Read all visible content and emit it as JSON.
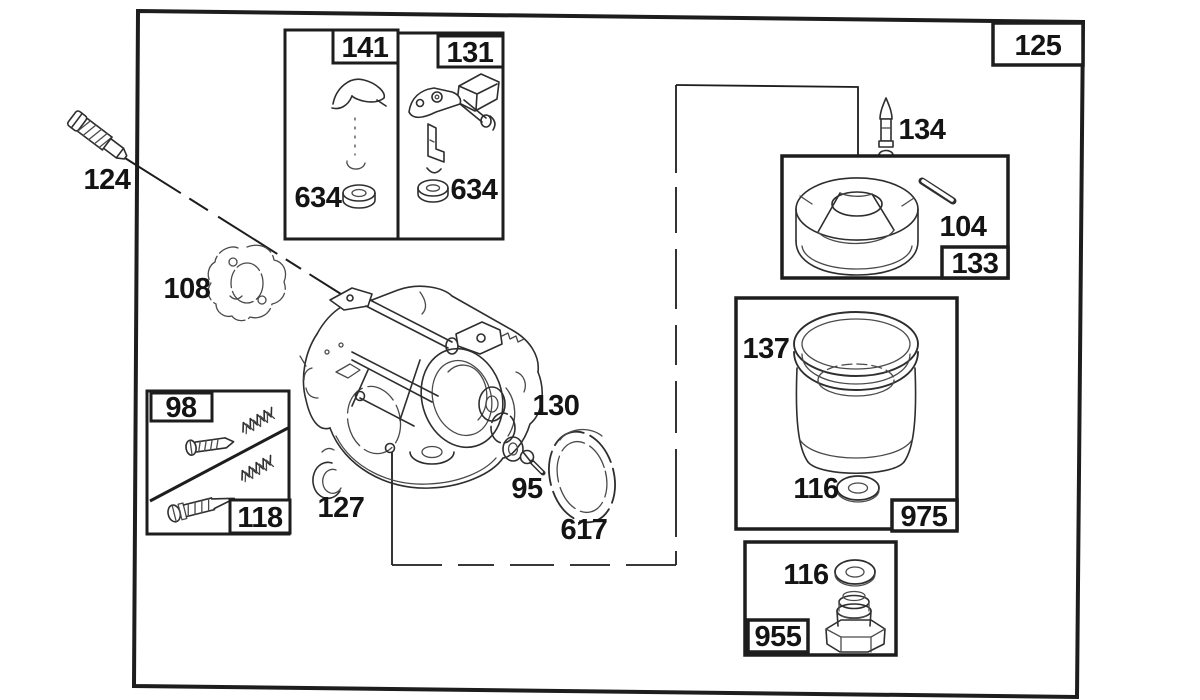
{
  "diagram": {
    "assembly_callout": "125",
    "inset_boxes": {
      "box_141": {
        "label": "141",
        "washer": "634"
      },
      "box_131": {
        "label": "131",
        "washer": "634"
      },
      "box_133": {
        "label": "133",
        "pin": "104"
      },
      "box_98_118": {
        "label_top": "98",
        "label_bottom": "118"
      },
      "box_975": {
        "label": "975",
        "oring": "137",
        "washer": "116"
      },
      "box_955": {
        "label": "955",
        "washer": "116"
      }
    },
    "free_callouts": {
      "mounting_screw": "124",
      "gasket": "108",
      "needle_valve": "134",
      "gasket_stack": "130",
      "bowl_screw": "95",
      "seal": "127",
      "diaphragm_ring": "617"
    },
    "colors": {
      "line": "#1d1d1d",
      "background": "#ffffff",
      "label_text": "#141414"
    }
  }
}
